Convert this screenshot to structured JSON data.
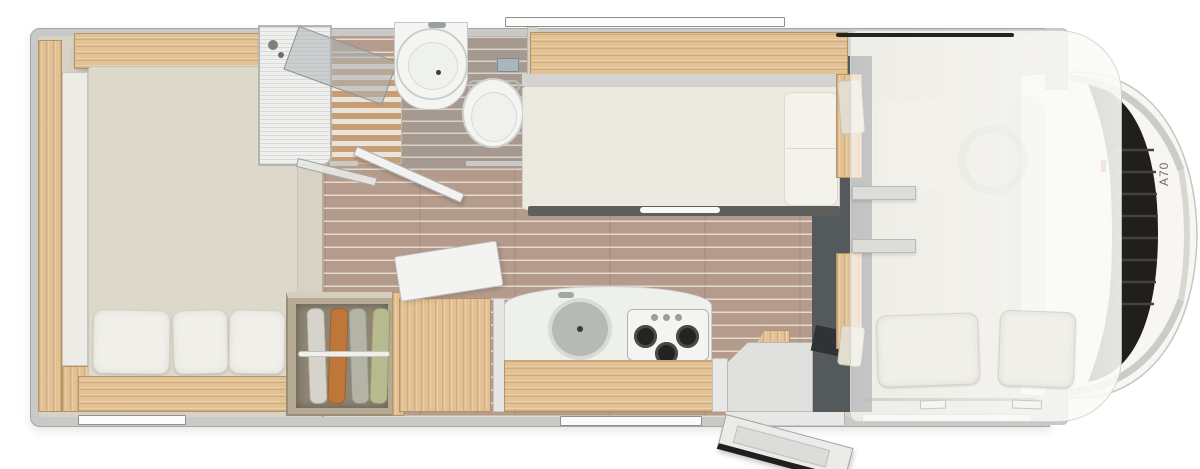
{
  "vehicle": {
    "model_label": "A70"
  },
  "colors": {
    "background": "#ffffff",
    "wall": "#c9c9c7",
    "wall_edge": "#a6a6a4",
    "interior": "#d6d2c6",
    "wood": "#e2c194",
    "floor_plank": "#b49b8b",
    "porcelain": "#f4f5f3",
    "mattress": "#ece9e1",
    "pillow": "#f0efe9",
    "cab_floor": "#54595c",
    "dark_detail": "#232321",
    "chrome": "#ccccc6",
    "red_marker": "#c0392b",
    "clothes_white": "#d6d4ca",
    "clothes_orange": "#bf7639",
    "clothes_gray": "#b4b4a6",
    "clothes_green": "#b7ba8e"
  },
  "fixtures": [
    "rear-double-bed",
    "rear-bed-pillows",
    "left-wardrobe-cabinet",
    "shower-cabin",
    "shower-glass-door",
    "washbasin",
    "toilet",
    "bathroom-door",
    "wardrobe-with-clothes",
    "refrigerator",
    "kitchen-counter",
    "kitchen-sink",
    "gas-hob-3-burner",
    "entry-door",
    "entrance-step",
    "single-bed",
    "overhead-shelf",
    "cab-seats",
    "alcove-bed-overlay",
    "alcove-ladder",
    "alcove-pillows",
    "steering-wheel",
    "windshield",
    "hood",
    "wall-windows"
  ]
}
